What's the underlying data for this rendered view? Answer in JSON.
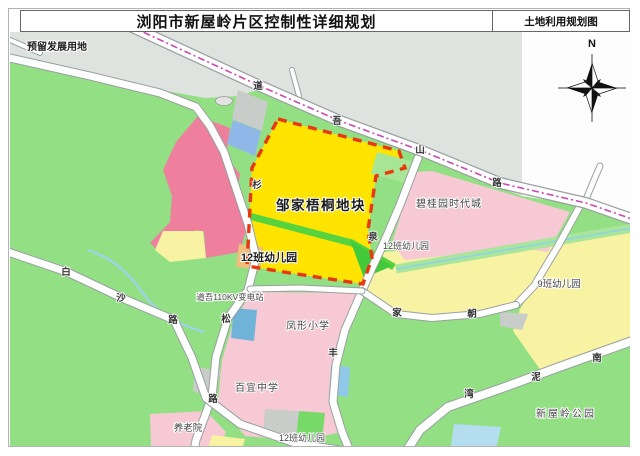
{
  "page": {
    "title": "浏阳市新屋岭片区控制性详细规划",
    "map_type": "土地利用规划图"
  },
  "compass": {
    "label": "N"
  },
  "colors": {
    "green_base": "#92e083",
    "grey_reserved": "#dfe3df",
    "bright_yellow_plot": "#ffe400",
    "pale_yellow": "#f8f2a3",
    "pink_parcel": "#f6c9d4",
    "rose_parcel": "#ee7f9d",
    "orange_kindergarten": "#f0bf7d",
    "blue_substation": "#6fb3d9",
    "boundary_red_dash": "#e8380d",
    "planning_line_magenta": "#c84ab0",
    "water_blue": "#8ed2e8"
  },
  "map": {
    "site_labels": [
      {
        "text": "预留发展用地",
        "x": 57,
        "y": 50,
        "size": 10,
        "bold": true,
        "ls": 0
      },
      {
        "text": "邹家梧桐地块",
        "x": 321,
        "y": 210,
        "size": 13.5,
        "bold": true,
        "ls": 1.5
      },
      {
        "text": "12班幼儿园",
        "x": 269,
        "y": 261,
        "size": 11,
        "bold": true,
        "ls": 0
      },
      {
        "text": "12班幼儿园",
        "x": 406,
        "y": 249,
        "size": 9,
        "bold": false,
        "ls": 0
      },
      {
        "text": "碧桂园时代城",
        "x": 449,
        "y": 207,
        "size": 10,
        "bold": false,
        "ls": 1
      },
      {
        "text": "9班幼儿园",
        "x": 559,
        "y": 287,
        "size": 9.5,
        "bold": false,
        "ls": 0
      },
      {
        "text": "道吾110KV变电站",
        "x": 230,
        "y": 300,
        "size": 8.5,
        "bold": false,
        "ls": 0
      },
      {
        "text": "凤形小学",
        "x": 308,
        "y": 329,
        "size": 10,
        "bold": false,
        "ls": 1
      },
      {
        "text": "百宜中学",
        "x": 257,
        "y": 391,
        "size": 10,
        "bold": false,
        "ls": 1
      },
      {
        "text": "养老院",
        "x": 188,
        "y": 431,
        "size": 9.5,
        "bold": false,
        "ls": 0
      },
      {
        "text": "12班幼儿园",
        "x": 302,
        "y": 441,
        "size": 9,
        "bold": false,
        "ls": 0
      },
      {
        "text": "新屋岭公园",
        "x": 566,
        "y": 417,
        "size": 10,
        "bold": false,
        "ls": 2
      }
    ],
    "road_chars": [
      {
        "text": "道",
        "x": 258,
        "y": 89
      },
      {
        "text": "吾",
        "x": 337,
        "y": 124
      },
      {
        "text": "山",
        "x": 420,
        "y": 153
      },
      {
        "text": "路",
        "x": 497,
        "y": 186
      },
      {
        "text": "白",
        "x": 66,
        "y": 275
      },
      {
        "text": "沙",
        "x": 121,
        "y": 301
      },
      {
        "text": "路",
        "x": 173,
        "y": 323
      },
      {
        "text": "杉",
        "x": 257,
        "y": 188
      },
      {
        "text": "松",
        "x": 226,
        "y": 322
      },
      {
        "text": "路",
        "x": 213,
        "y": 402
      },
      {
        "text": "泉",
        "x": 373,
        "y": 240
      },
      {
        "text": "丰",
        "x": 333,
        "y": 356
      },
      {
        "text": "家",
        "x": 397,
        "y": 316
      },
      {
        "text": "朝",
        "x": 472,
        "y": 317
      },
      {
        "text": "湾",
        "x": 469,
        "y": 397
      },
      {
        "text": "泥",
        "x": 536,
        "y": 380
      },
      {
        "text": "南",
        "x": 597,
        "y": 361
      }
    ]
  }
}
